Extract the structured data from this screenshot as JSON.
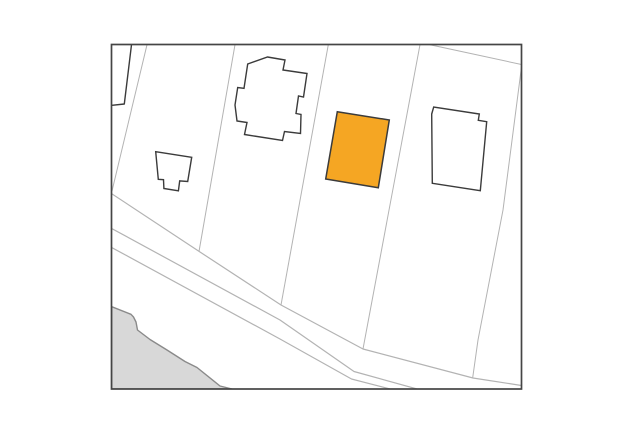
{
  "map": {
    "canvas": {
      "width": 631,
      "height": 440,
      "background": "#ffffff"
    },
    "frame": {
      "x": 111.5,
      "y": 44.5,
      "w": 410,
      "h": 344.5,
      "stroke": "#454545",
      "stroke_width": 1.7,
      "fill": "#ffffff"
    },
    "colors": {
      "parcel_line": "#b3b3b3",
      "building_stroke": "#3b3b3b",
      "building_fill": "#ffffff",
      "highlight_fill": "#f5a623",
      "area_fill": "#d8d8d8",
      "area_stroke": "#8a8a8a"
    },
    "areas": [
      {
        "name": "shaded-terrain-area",
        "interactable": "false",
        "fill": "#d8d8d8",
        "stroke": "#8a8a8a",
        "stroke_width": 1.4,
        "points": [
          [
            111.7,
            306.7
          ],
          [
            131,
            314.3
          ],
          [
            133.5,
            317
          ],
          [
            136,
            322
          ],
          [
            137.5,
            330
          ],
          [
            150,
            339.5
          ],
          [
            167,
            350
          ],
          [
            185,
            361.5
          ],
          [
            197,
            367.5
          ],
          [
            220,
            386
          ],
          [
            232,
            389
          ],
          [
            111.7,
            389
          ]
        ]
      }
    ],
    "lines": [
      {
        "name": "road-edge-upper",
        "interactable": "false",
        "stroke": "#b3b3b3",
        "stroke_width": 1.2,
        "points": [
          [
            111.7,
            193.7
          ],
          [
            200,
            252
          ],
          [
            281,
            305
          ],
          [
            363,
            349
          ],
          [
            473,
            378
          ],
          [
            521.5,
            385.5
          ]
        ]
      },
      {
        "name": "road-edge-middle",
        "interactable": "false",
        "stroke": "#b3b3b3",
        "stroke_width": 1.2,
        "points": [
          [
            111.7,
            228.5
          ],
          [
            280,
            320
          ],
          [
            354,
            371.5
          ],
          [
            417,
            389
          ]
        ]
      },
      {
        "name": "road-edge-lower",
        "interactable": "false",
        "stroke": "#b3b3b3",
        "stroke_width": 1.2,
        "points": [
          [
            111.7,
            247.5
          ],
          [
            280,
            339
          ],
          [
            351.5,
            379
          ],
          [
            390,
            389
          ]
        ]
      },
      {
        "name": "parcel-line-west",
        "interactable": "false",
        "stroke": "#b3b3b3",
        "stroke_width": 1,
        "points": [
          [
            147,
            44.7
          ],
          [
            112,
            191
          ]
        ]
      },
      {
        "name": "parcel-line-left-of-cross-building",
        "interactable": "false",
        "stroke": "#b3b3b3",
        "stroke_width": 1,
        "points": [
          [
            235,
            44.7
          ],
          [
            199,
            251.5
          ]
        ]
      },
      {
        "name": "parcel-line-left-of-highlight",
        "interactable": "false",
        "stroke": "#b3b3b3",
        "stroke_width": 1,
        "points": [
          [
            328.3,
            44.7
          ],
          [
            281,
            305
          ]
        ]
      },
      {
        "name": "parcel-line-right-of-highlight",
        "interactable": "false",
        "stroke": "#b3b3b3",
        "stroke_width": 1,
        "points": [
          [
            420,
            44.7
          ],
          [
            363,
            349
          ]
        ]
      },
      {
        "name": "parcel-line-east",
        "interactable": "false",
        "stroke": "#b3b3b3",
        "stroke_width": 1,
        "points": [
          [
            521.5,
            67
          ],
          [
            503,
            210
          ],
          [
            478,
            340
          ],
          [
            472.7,
            377.7
          ]
        ]
      },
      {
        "name": "parcel-line-top-right-corner",
        "interactable": "false",
        "stroke": "#b3b3b3",
        "stroke_width": 1,
        "points": [
          [
            430,
            44.7
          ],
          [
            521.5,
            64.5
          ]
        ]
      },
      {
        "name": "building-outline-clipped-corner",
        "interactable": "false",
        "stroke": "#3b3b3b",
        "stroke_width": 1.4,
        "points": [
          [
            131.5,
            44.7
          ],
          [
            124.3,
            104
          ],
          [
            112,
            105.3
          ]
        ]
      }
    ],
    "buildings": [
      {
        "name": "building-small-house",
        "interactable": "false",
        "fill": "#ffffff",
        "stroke": "#3b3b3b",
        "stroke_width": 1.4,
        "points": [
          [
            155.7,
            151.7
          ],
          [
            191.7,
            157.3
          ],
          [
            187.7,
            181.5
          ],
          [
            179.7,
            180.9
          ],
          [
            178.4,
            190.8
          ],
          [
            163.9,
            188.5
          ],
          [
            163.5,
            179.7
          ],
          [
            158.3,
            179.3
          ]
        ]
      },
      {
        "name": "building-cross-shaped",
        "interactable": "false",
        "fill": "#ffffff",
        "stroke": "#3b3b3b",
        "stroke_width": 1.4,
        "points": [
          [
            267.5,
            57
          ],
          [
            285,
            60
          ],
          [
            283,
            70
          ],
          [
            307,
            73.5
          ],
          [
            303.5,
            97
          ],
          [
            298.5,
            96
          ],
          [
            296,
            113.5
          ],
          [
            301,
            114.5
          ],
          [
            300.5,
            133.5
          ],
          [
            284.5,
            131.5
          ],
          [
            282.5,
            140.5
          ],
          [
            244.5,
            134.5
          ],
          [
            247,
            122.5
          ],
          [
            237,
            121
          ],
          [
            235,
            105
          ],
          [
            237.7,
            87.5
          ],
          [
            244,
            88.3
          ],
          [
            247.7,
            64
          ]
        ]
      },
      {
        "name": "building-highlighted",
        "interactable": "true",
        "fill": "#f5a623",
        "stroke": "#3b3b3b",
        "stroke_width": 1.5,
        "points": [
          [
            337.3,
            111.7
          ],
          [
            389.3,
            120
          ],
          [
            378.3,
            187.7
          ],
          [
            325.7,
            179
          ]
        ]
      },
      {
        "name": "building-east-notched",
        "interactable": "false",
        "fill": "#ffffff",
        "stroke": "#3b3b3b",
        "stroke_width": 1.4,
        "points": [
          [
            431.7,
            114
          ],
          [
            433.7,
            107
          ],
          [
            479.3,
            114
          ],
          [
            478.3,
            120.3
          ],
          [
            486.7,
            121.7
          ],
          [
            480.3,
            190.7
          ],
          [
            432.3,
            183.3
          ]
        ]
      }
    ]
  }
}
